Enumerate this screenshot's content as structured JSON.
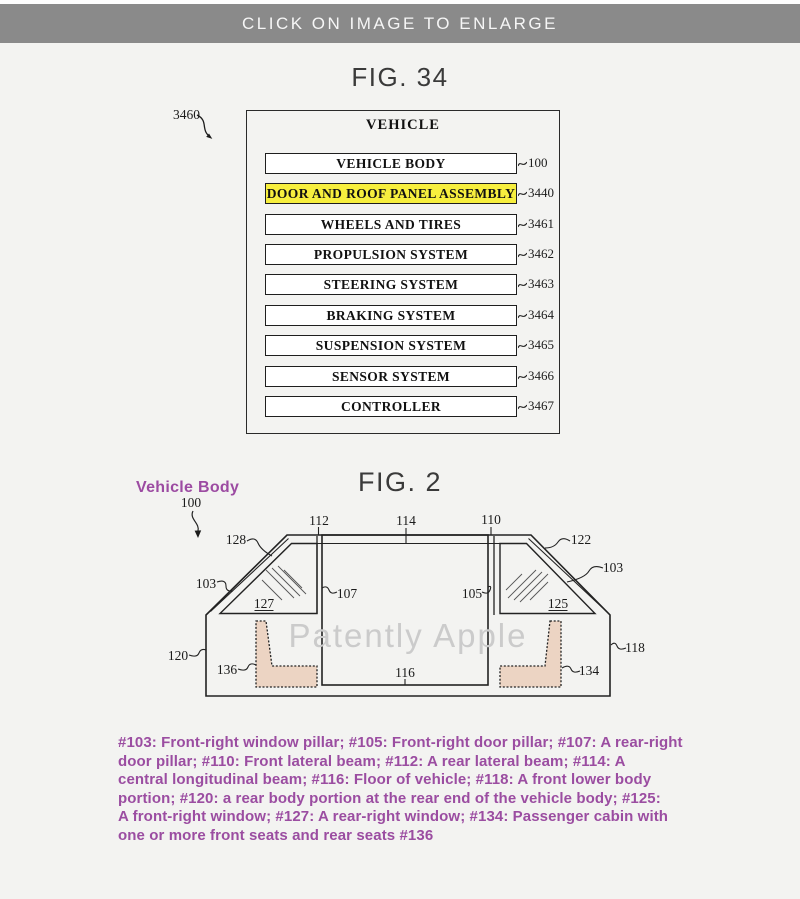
{
  "banner": {
    "text": "CLICK ON IMAGE TO ENLARGE",
    "background": "#8a8a8a",
    "text_color": "#f6f6f6"
  },
  "fig34": {
    "title": "FIG. 34",
    "figure_ref": "3460",
    "container_label": "VEHICLE",
    "highlight_color": "#f7ef3e",
    "rows": [
      {
        "label": "VEHICLE BODY",
        "ref": "100",
        "highlighted": false
      },
      {
        "label": "DOOR AND ROOF PANEL ASSEMBLY",
        "ref": "3440",
        "highlighted": true
      },
      {
        "label": "WHEELS AND TIRES",
        "ref": "3461",
        "highlighted": false
      },
      {
        "label": "PROPULSION SYSTEM",
        "ref": "3462",
        "highlighted": false
      },
      {
        "label": "STEERING SYSTEM",
        "ref": "3463",
        "highlighted": false
      },
      {
        "label": "BRAKING SYSTEM",
        "ref": "3464",
        "highlighted": false
      },
      {
        "label": "SUSPENSION SYSTEM",
        "ref": "3465",
        "highlighted": false
      },
      {
        "label": "SENSOR SYSTEM",
        "ref": "3466",
        "highlighted": false
      },
      {
        "label": "CONTROLLER",
        "ref": "3467",
        "highlighted": false
      }
    ]
  },
  "fig2": {
    "title": "FIG. 2",
    "body_label": "Vehicle Body",
    "body_label_color": "#9c4ba2",
    "watermark": "Patently Apple",
    "seat_fill": "#ecd4c3",
    "refs": {
      "n100": "100",
      "n103_left": "103",
      "n103_right": "103",
      "n105": "105",
      "n107": "107",
      "n110": "110",
      "n112": "112",
      "n114": "114",
      "n116": "116",
      "n118": "118",
      "n120": "120",
      "n122": "122",
      "n125": "125",
      "n127": "127",
      "n128": "128",
      "n134": "134",
      "n136": "136"
    }
  },
  "caption": {
    "color": "#9b4da1",
    "lines": [
      "#103: Front-right window pillar; #105: Front-right door pillar; #107: A rear-right",
      "door pillar; #110: Front lateral beam; #112: A rear lateral beam; #114: A",
      "central longitudinal beam; #116: Floor of vehicle; #118: A front lower body",
      "portion; #120: a rear body portion at the rear end of the vehicle body; #125:",
      "A front-right window; #127: A rear-right window; #134: Passenger cabin with",
      "one or more front seats and rear seats #136"
    ]
  }
}
